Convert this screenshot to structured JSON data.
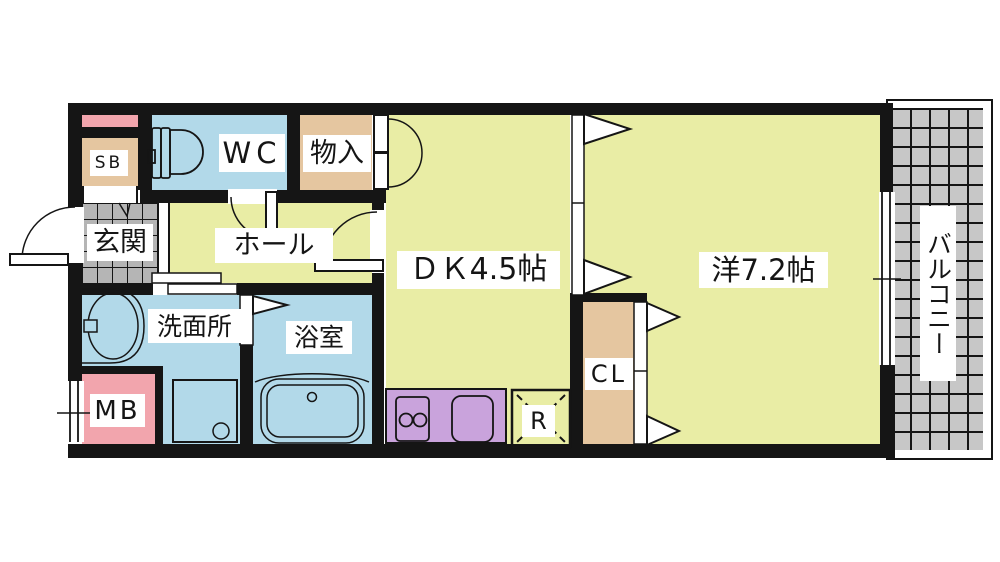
{
  "meta": {
    "type": "floor-plan",
    "description": "Japanese 1DK apartment floor plan with balcony",
    "unit_layout": "1DK"
  },
  "labels": {
    "shoe_box": "SB",
    "toilet": "WC",
    "storage": "物入",
    "entrance": "玄関",
    "hall": "ホール",
    "dining_kitchen": "ＤＫ4.5帖",
    "western_room": "洋7.2帖",
    "balcony": "バルコニー",
    "washroom": "洗面所",
    "bathroom": "浴室",
    "meter_box": "MB",
    "closet": "CL",
    "refrigerator": "R"
  },
  "room_sizes": {
    "dining_kitchen": "4.5帖",
    "western_room": "7.2帖"
  },
  "colors": {
    "room_yellow": "#e9eda5",
    "water_blue": "#b2d9e9",
    "storage_tan": "#e5c6a0",
    "pipe_pink": "#f2a5ad",
    "kitchen_purple": "#c9a3dc",
    "tile_gray": "#b5b5b5",
    "balcony_gray": "#c7c7c7",
    "wall": "#151515",
    "background": "#ffffff"
  },
  "fixtures": [
    "toilet-icon",
    "wash-basin-icon",
    "washing-machine-pan-icon",
    "bathtub-icon",
    "gas-stove-icon",
    "kitchen-sink-icon",
    "refrigerator-space-icon",
    "entrance-door-swing",
    "wc-door-swing",
    "dk-door-swing",
    "storage-double-door",
    "bathroom-folding-door",
    "sliding-partition",
    "closet-sliding-doors",
    "window-double-line"
  ]
}
